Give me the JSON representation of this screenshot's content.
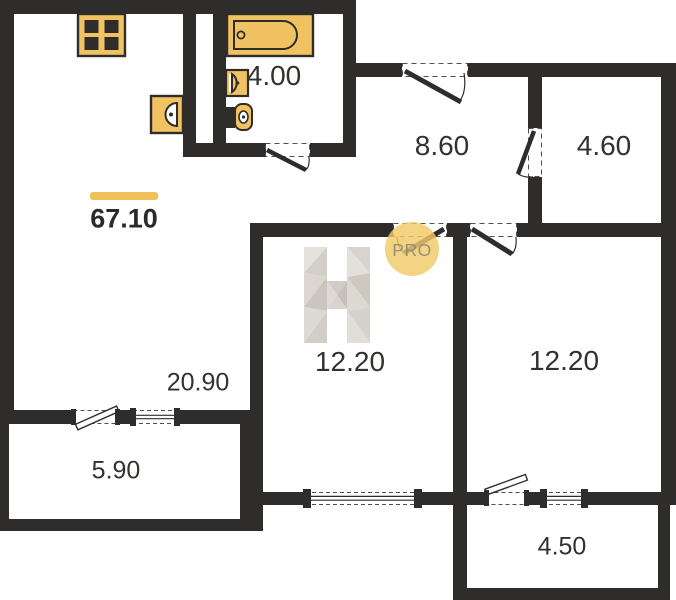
{
  "plan": {
    "total_area": {
      "value": "67.10"
    },
    "rooms": [
      {
        "name": "bathroom",
        "area": "4.00"
      },
      {
        "name": "hallway",
        "area": "8.60"
      },
      {
        "name": "storage",
        "area": "4.60"
      },
      {
        "name": "bedroom-left",
        "area": "12.20"
      },
      {
        "name": "bedroom-right",
        "area": "12.20"
      },
      {
        "name": "living-kitchen",
        "area": "20.90"
      },
      {
        "name": "balcony-left",
        "area": "5.90"
      },
      {
        "name": "balcony-right",
        "area": "4.50"
      }
    ],
    "watermark": {
      "logo": "H",
      "badge_label": "PRO"
    },
    "colors": {
      "wall": "#2e2d2b",
      "fixture_fill": "#f1c261",
      "accent_bar": "#f0c05a",
      "badge_fill": "#f2c968"
    },
    "fixtures": [
      "stove",
      "bathtub",
      "bathroom-sink",
      "toilet",
      "kitchen-sink"
    ]
  }
}
